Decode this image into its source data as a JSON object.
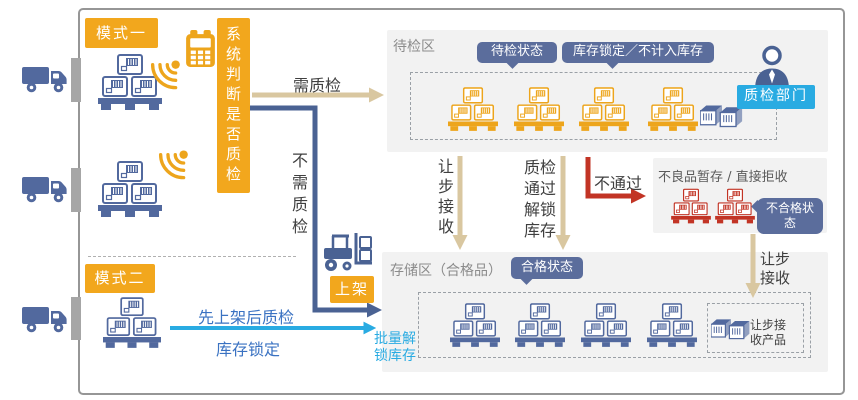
{
  "colors": {
    "orange": "#F2A71D",
    "pallet_blue": "#52699E",
    "line_blue": "#4A6293",
    "tan_arrow": "#D9C7A0",
    "red": "#C23425",
    "cyan": "#29ABE2",
    "badge_blue": "#5B6D9C",
    "flow_text_blue": "#3A72C2",
    "zone_gray": "#F2F2F2"
  },
  "modes": {
    "mode1_label": "模式一",
    "mode2_label": "模式二",
    "decision_text": "系统判断是否质检",
    "shelve_label": "上架"
  },
  "flows": {
    "need_qc": "需质检",
    "no_need_qc": "不需质检",
    "mode2_line1": "先上架后质检",
    "mode2_line2": "库存锁定",
    "batch_unlock": "批量解\n锁库存",
    "concession_1": "让步接收",
    "qc_pass": "质检\n通过\n解锁\n库存",
    "qc_fail": "不通过",
    "concession_2": "让步\n接收"
  },
  "pending_zone": {
    "title": "待检区",
    "status_badge": "待检状态",
    "lock_badge": "库存锁定／不计入库存",
    "inspector_badge": "质检部门"
  },
  "defect_zone": {
    "title": "不良品暂存 / 直接拒收",
    "status_badge": "不合格状\n态"
  },
  "storage_zone": {
    "title": "存储区（合格品）",
    "status_badge": "合格状态",
    "concession_label": "让步接\n收产品"
  }
}
